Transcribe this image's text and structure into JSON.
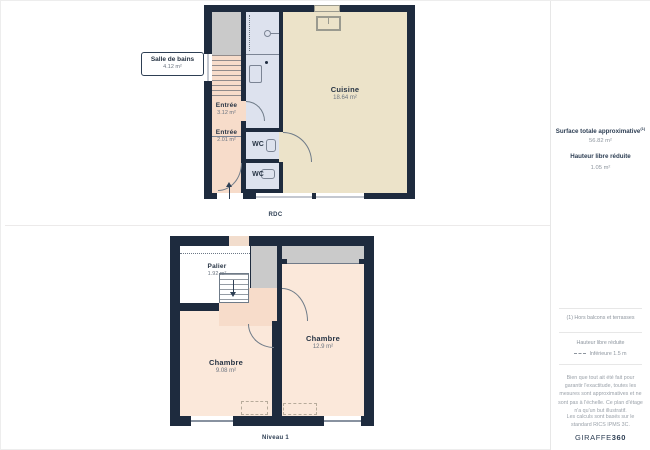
{
  "rdc": {
    "caption": "RDC",
    "rooms": {
      "salle_de_bains": {
        "label": "Salle de bains",
        "area": "4.12 m²"
      },
      "entree_1": {
        "label": "Entrée",
        "area": "3.12 m²"
      },
      "entree_2": {
        "label": "Entrée",
        "area": "2.01 m²"
      },
      "wc_1": {
        "label": "WC"
      },
      "wc_2": {
        "label": "WC"
      },
      "cuisine": {
        "label": "Cuisine",
        "area": "18.64 m²"
      }
    }
  },
  "niveau1": {
    "caption": "Niveau 1",
    "rooms": {
      "palier": {
        "label": "Palier",
        "area": "1.92 m²"
      },
      "chambre_droite": {
        "label": "Chambre",
        "area": "12.9 m²"
      },
      "chambre_gauche": {
        "label": "Chambre",
        "area": "9.08 m²"
      }
    }
  },
  "sidebar": {
    "surface_label": "Surface totale approximative",
    "surface_sup": "(1)",
    "surface_value": "56.82 m²",
    "height_label": "Hauteur libre réduite",
    "height_value": "1.05 m²",
    "footnote": "(1) Hors balcons et terrasses",
    "legend_title": "Hauteur libre réduite",
    "legend_item": "Inférieure 1.5 m",
    "disclaimer": "Bien que tout ait été fait pour garantir l'exactitude, toutes les mesures sont approximatives et ne sont pas à l'échelle. Ce plan d'étage n'a qu'un but illustratif.",
    "standard": "Les calculs sont basés sur le standard RICS IPMS 3C.",
    "brand": "GIRAFFE",
    "brand_bold": "360"
  },
  "colors": {
    "wall": "#1e2b3e",
    "cuisine_fill": "#ece3c9",
    "entree_fill": "#f7dcca",
    "wc_fill": "#dde2ee",
    "chambre_fill": "#fbe8da",
    "reduced_height_gray": "#cacaca"
  }
}
